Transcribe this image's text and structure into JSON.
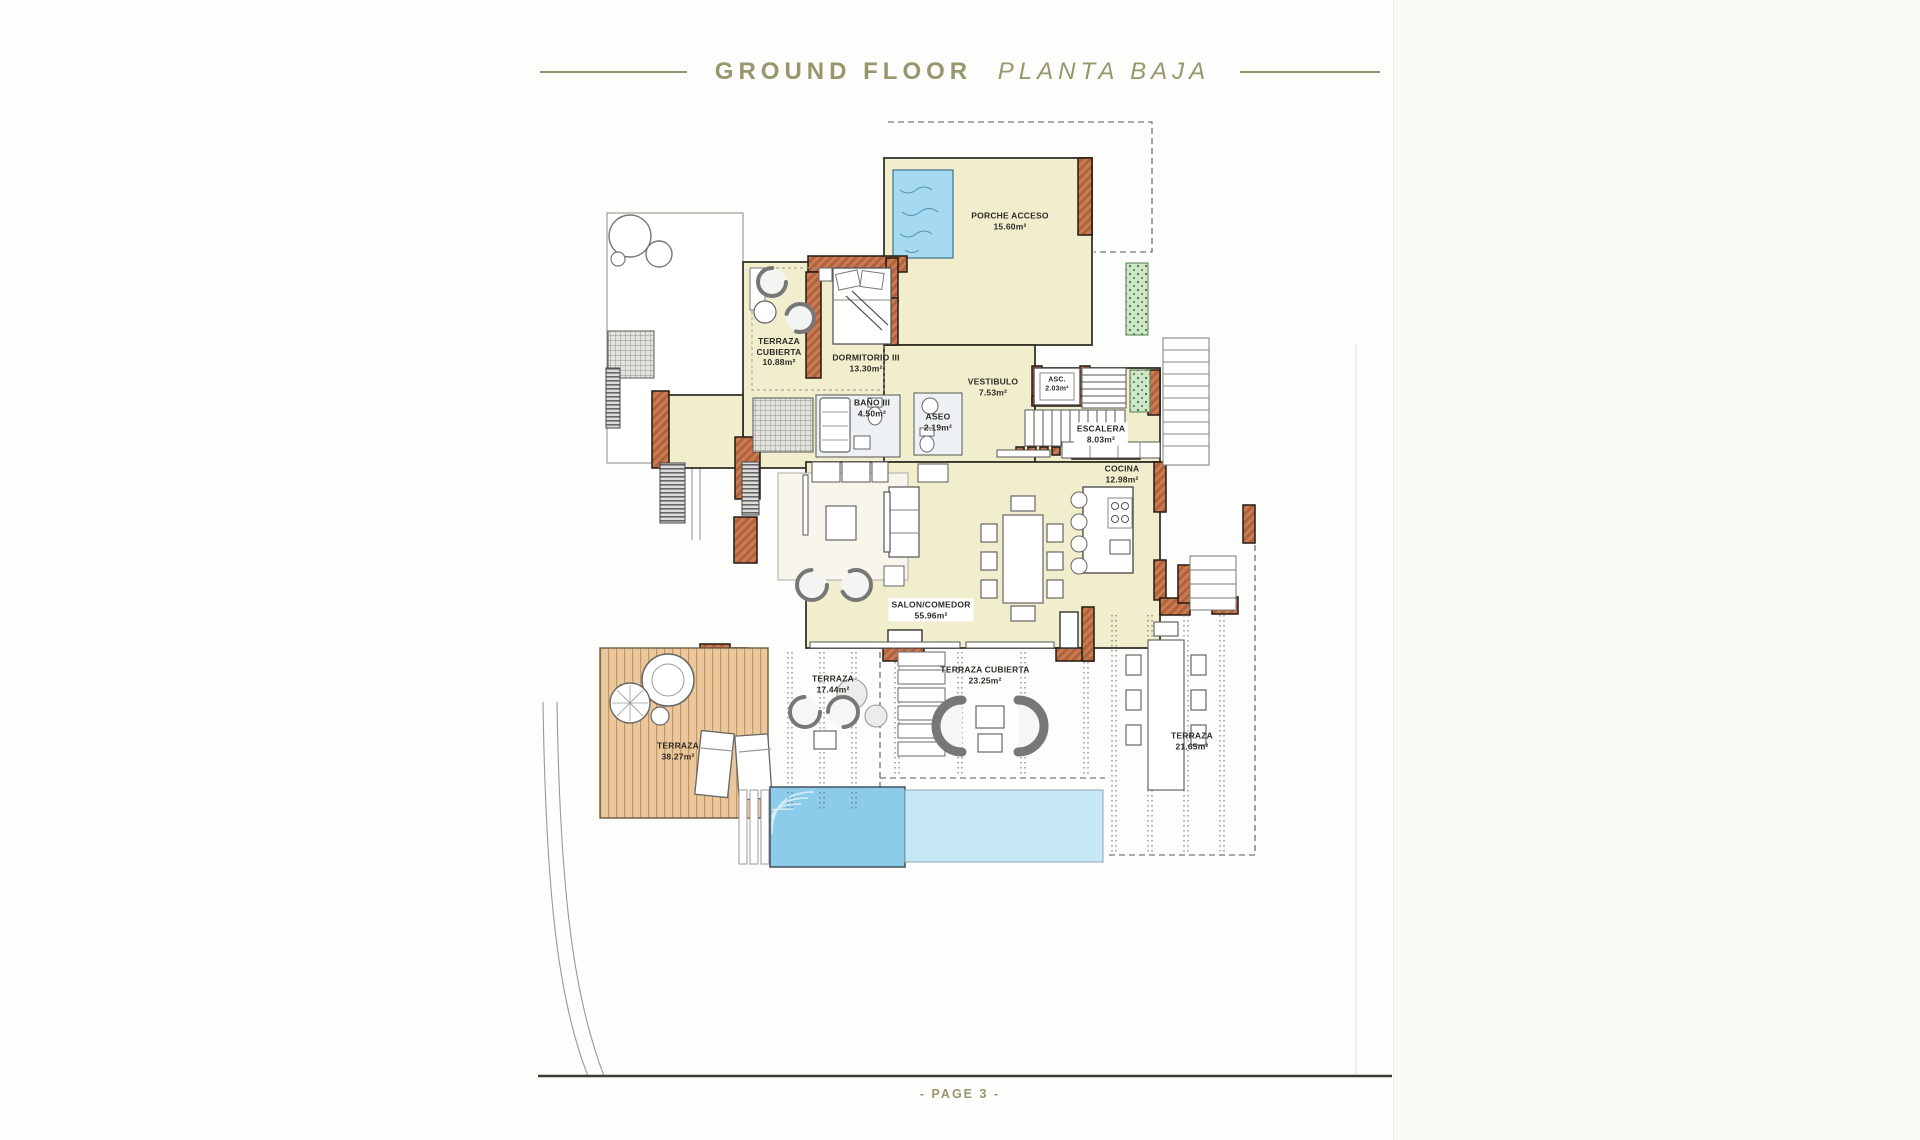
{
  "header": {
    "title_en": "GROUND FLOOR",
    "title_es": "PLANTA BAJA"
  },
  "footer": {
    "page_label": "- PAGE 3 -"
  },
  "colors": {
    "accent_olive": "#97966c",
    "room_cream": "#f1eecd",
    "wall_terracotta": "#c87c54",
    "pool_water": "#a6daf1",
    "deck_wood": "#ebc79d",
    "planter_green": "#cfe6c8"
  },
  "rooms": [
    {
      "id": "porche-acceso",
      "name": "PORCHE ACCESO",
      "area": "15.60m²",
      "x": 1010,
      "y": 221
    },
    {
      "id": "terraza-cubierta-upper",
      "name": "TERRAZA CUBIERTA",
      "area": "10.88m²",
      "x": 779,
      "y": 352,
      "w": 56
    },
    {
      "id": "dormitorio-iii",
      "name": "DORMITORIO III",
      "area": "13.30m²",
      "x": 866,
      "y": 363
    },
    {
      "id": "bano-iii",
      "name": "BAÑO III",
      "area": "4.50m²",
      "x": 872,
      "y": 408
    },
    {
      "id": "aseo",
      "name": "ASEO",
      "area": "2.19m²",
      "x": 938,
      "y": 422
    },
    {
      "id": "vestibulo",
      "name": "VESTIBULO",
      "area": "7.53m²",
      "x": 993,
      "y": 387
    },
    {
      "id": "ascensor",
      "name": "ASC.",
      "area": "2.03m²",
      "x": 1057,
      "y": 385,
      "fs": 7
    },
    {
      "id": "escalera",
      "name": "ESCALERA",
      "area": "8.03m²",
      "x": 1101,
      "y": 434,
      "boxed": true
    },
    {
      "id": "cocina",
      "name": "COCINA",
      "area": "12.98m²",
      "x": 1122,
      "y": 474
    },
    {
      "id": "salon-comedor",
      "name": "SALON/COMEDOR",
      "area": "55.96m²",
      "x": 931,
      "y": 610,
      "boxed": true
    },
    {
      "id": "terraza-izquierda",
      "name": "TERRAZA",
      "area": "17.44m²",
      "x": 833,
      "y": 684
    },
    {
      "id": "terraza-cubierta-lower",
      "name": "TERRAZA CUBIERTA",
      "area": "23.25m²",
      "x": 985,
      "y": 675
    },
    {
      "id": "terraza-derecha",
      "name": "TERRAZA",
      "area": "21.65m²",
      "x": 1192,
      "y": 741,
      "w": 52
    },
    {
      "id": "terraza-deck",
      "name": "TERRAZA",
      "area": "38.27m²",
      "x": 678,
      "y": 751,
      "w": 52
    }
  ]
}
